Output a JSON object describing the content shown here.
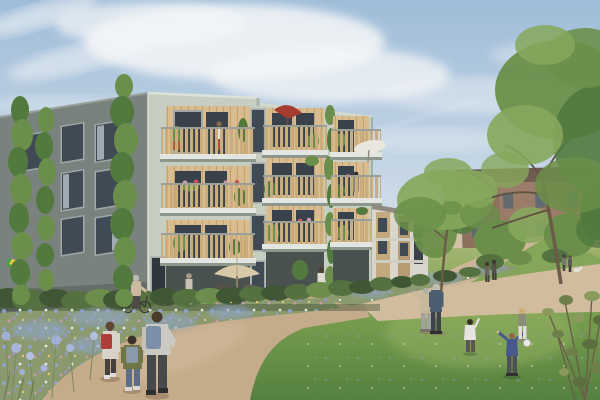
{
  "scene": {
    "type": "architectural-rendering",
    "setting": "modern residential block with timber balconies in a green courtyard with gravel paths, wildflower meadows and mature trees",
    "palette": {
      "sky_top": "#9fbcd8",
      "sky_mid": "#c6d6e5",
      "sky_horizon": "#e4eaee",
      "cloud_white": "#f5f7f8",
      "facade_gray": "#79827d",
      "facade_gray_shade": "#656d68",
      "facade_sage": "#c6cec2",
      "facade_sage_shade": "#aab4a8",
      "parapet": "#dde2d8",
      "balcony_wood": "#d9bd90",
      "railing_wood": "#c9ad7c",
      "slab_concrete": "#e2e5e0",
      "slab_shadow": "#8e978c",
      "window_glass": "#3f4a54",
      "balcony_glass": "#39424a",
      "window_frame": "#a2a8a8",
      "hedge_dark": "#3f5735",
      "hedge_mid": "#54713f",
      "hedge_light": "#6c8d4b",
      "grass_light": "#a3b574",
      "grass_mid": "#7aa050",
      "grass_dark": "#55803f",
      "meadow_base": "#8a9a6e",
      "flower_blue": "#8fa5d2",
      "flower_purple": "#9e8fc7",
      "flower_pink": "#cf9bb0",
      "flower_white": "#eef0f3",
      "flower_yellow": "#e3cf6e",
      "path_light": "#d2bc9e",
      "path_mid": "#c4ab8a",
      "path_far": "#cdb697",
      "path_shade": "#a78d6f",
      "tree_light": "#86a75c",
      "tree_mid": "#6b8f4a",
      "tree_dark": "#527a3e",
      "trunk_brown": "#6a5c49",
      "brick_wall": "#9a7c69",
      "brick_roof": "#6f5b51",
      "bg_window": "#5d6a72",
      "wing_white": "#d8d6cd",
      "wing_wood": "#c3a87e",
      "umbrella_red": "#a63c30",
      "umbrella_cream": "#d8c9a9",
      "umbrella_white": "#e9e6dd",
      "skin": "#d9b99a",
      "vent_pipe": "#c9b391"
    },
    "main_building": {
      "storeys": 4,
      "left_facade": "dark grey plaster, three window columns, columnar poplars in front",
      "front_facade": "pale sage plaster, three stacks of recessed timber-clad balconies",
      "balcony_features": [
        "timber slat railings",
        "potted plants",
        "flower boxes",
        "red parasol",
        "white parasol",
        "climbing vine"
      ],
      "ground_floor": "glazed terraces behind a hedge with a cream patio umbrella"
    },
    "background_buildings": {
      "brick_block": "four-storey brick building behind trees, dark roof",
      "timber_wing": "lower white and timber wing at the right of the main block"
    },
    "paths": "tan gravel paths meeting at a Y-junction in the meadow",
    "people": {
      "kite_kid": {
        "desc": "child running with rainbow kite",
        "shirt": "#5c8a4b",
        "shorts": "#4a4a48",
        "hair": "#6b523c"
      },
      "bike_woman": {
        "desc": "grey-haired woman pushing a bicycle by the hedge",
        "top": "#cbb9a0",
        "pants": "#4e4a46",
        "hair": "#bdb8b0"
      },
      "door_person": {
        "desc": "person at entrance",
        "top": "#c9c2b4",
        "pants": "#8a8378",
        "hair": "#a89a88"
      },
      "terrace_person": {
        "desc": "person standing on terrace",
        "top": "#dedbd2",
        "pants": "#5a5650",
        "hair": "#4a3f33"
      },
      "girl_red_backpack": {
        "desc": "girl with red backpack",
        "jacket": "#d7d3c9",
        "backpack": "#ad3f38",
        "hair": "#5f4936",
        "leggings": "#46413d",
        "shoes": "#e0dedd"
      },
      "kid_green_jacket": {
        "desc": "small child with olive jacket and blue backpack",
        "jacket": "#6e7547",
        "backpack": "#8b9aa8",
        "hair": "#3e3228",
        "jeans": "#5c6e85",
        "shoes": "#d8d8d4"
      },
      "boy_gray_hoodie": {
        "desc": "boy in grey hoodie with blue backpack",
        "hoodie": "#cbc9c4",
        "backpack": "#7b90a8",
        "hair": "#4a3a2c",
        "pants": "#46484a",
        "shoes": "#2e2e2e"
      },
      "elderly_woman": {
        "desc": "elderly woman pointing",
        "top": "#c7b79b",
        "pants": "#a3a29d",
        "hair": "#b5b0a8"
      },
      "elderly_man": {
        "desc": "elderly man in blue shirt",
        "shirt": "#4c5d72",
        "pants": "#3c434c",
        "hair": "#c3bfb7"
      },
      "ball_girl_white": {
        "desc": "girl in white playing ball",
        "top": "#e6e4de",
        "leggings": "#5a564f",
        "hair": "#372f26"
      },
      "ball_boy_blue": {
        "desc": "boy in blue tee with arms spread",
        "shirt": "#47598c",
        "pants": "#4e5055",
        "hair": "#8a6b44"
      },
      "ball_girl_gray": {
        "desc": "girl in grey top and white trousers",
        "top": "#8d8c79",
        "pants": "#dddcd6",
        "hair": "#c9ab72"
      },
      "walkers": {
        "desc": "two walkers on far path",
        "fig1": "#6b675f",
        "fig2": "#54504a",
        "hair": "#3f3a33"
      },
      "dog_walkers": {
        "desc": "couple walking a white dog",
        "fig1": "#7a756d",
        "fig2": "#5d5952"
      },
      "balcony_woman_top": {
        "desc": "woman on top corner balcony",
        "top": "#e8e4dc",
        "bottom": "#b04a40",
        "hair": "#8a6a4e"
      },
      "balcony_woman_mid": {
        "desc": "woman on right balcony",
        "dress": "#8a8578",
        "hair": "#3a332b"
      }
    },
    "props": {
      "ball": "#eceae4",
      "dog": "#e3e1da",
      "bicycle": "#3a3a38",
      "kite_colors": [
        "#4aa04a",
        "#e8c93f",
        "#cf5040",
        "#3f6fb5"
      ]
    }
  }
}
